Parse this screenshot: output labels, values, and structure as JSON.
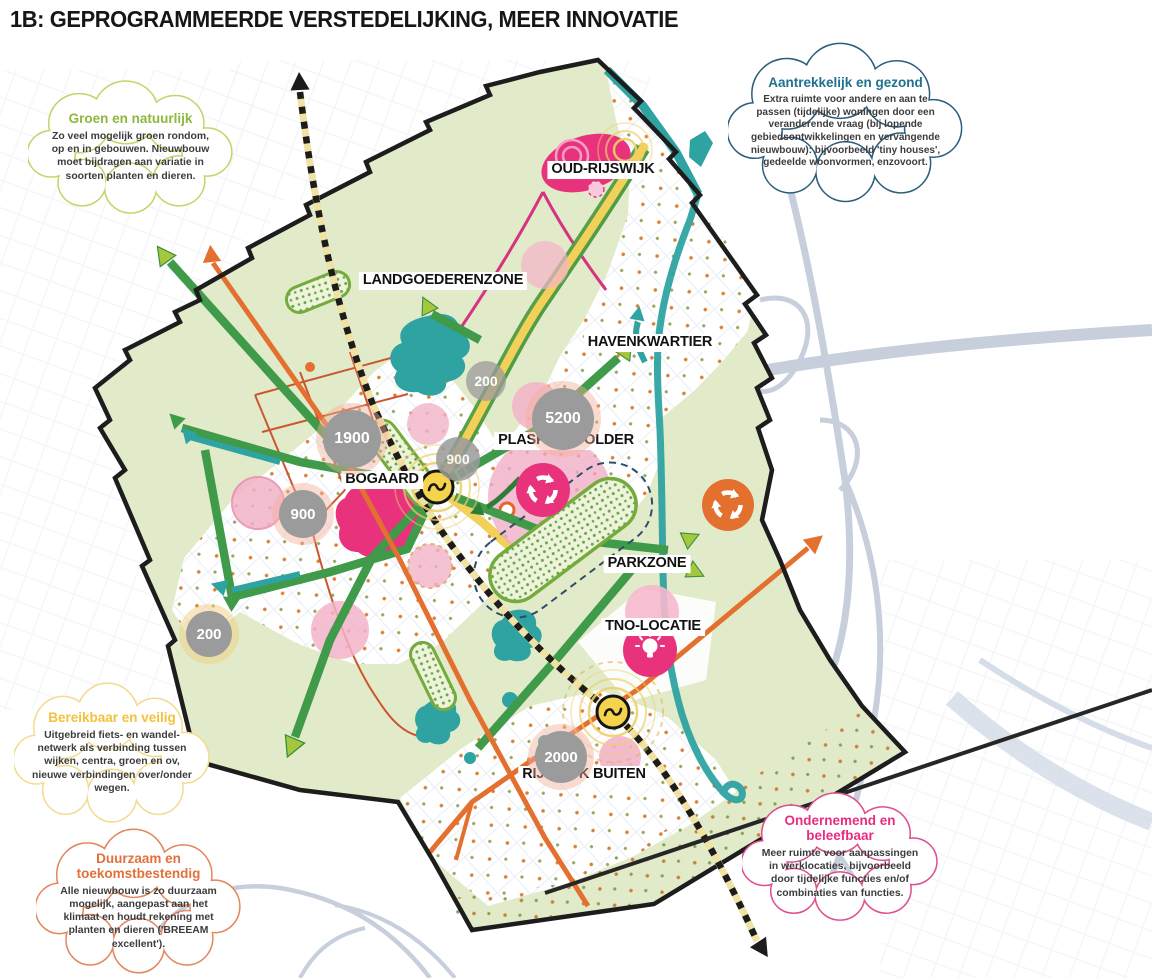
{
  "title": "1B: GEPROGRAMMEERDE VERSTEDELIJKING, MEER INNOVATIE",
  "clouds": {
    "groen": {
      "title": "Groen en natuurlijk",
      "body": "Zo veel mogelijk groen rondom, op en in gebouwen. Nieuwbouw moet bijdragen aan variatie in soorten planten en dieren.",
      "accent": "#8db83e"
    },
    "gezond": {
      "title": "Aantrekkelijk en gezond",
      "body": "Extra ruimte voor andere en aan te passen (tijdelijke) woningen door een veranderende vraag (bij lopende gebiedsontwikkelingen en vervangende nieuwbouw): bijvoorbeeld 'tiny houses', gedeelde woonvormen, enzovoort.",
      "accent": "#20718f"
    },
    "veilig": {
      "title": "Bereikbaar en veilig",
      "body": "Uitgebreid fiets- en wandel-netwerk als verbinding tussen wijken, centra, groen en ov, nieuwe verbindingen over/onder wegen.",
      "accent": "#f2c23a"
    },
    "duurzaam": {
      "title": "Duurzaam en toekomstbestendig",
      "body": "Alle nieuwbouw is zo duurzaam mogelijk, aangepast aan het klimaat en houdt rekening met planten en dieren ('BREEAM excellent').",
      "accent": "#e2703a"
    },
    "beleefbaar": {
      "title": "Ondernemend en beleefbaar",
      "body": "Meer ruimte voor aanpassingen in werklocaties, bijvoorbeeld door tijdelijke functies en/of combinaties van functies.",
      "accent": "#e82c80"
    }
  },
  "map": {
    "labels": {
      "oud_rijswijk": "OUD-RIJSWIJK",
      "landgoederenzone": "LANDGOEDERENZONE",
      "havenkwartier": "HAVENKWARTIER",
      "plaspoelpolder": "PLASPOELPOLDER",
      "bogaard": "BOGAARD",
      "parkzone": "PARKZONE",
      "tno": "TNO-LOCATIE",
      "rijswijk_buiten": "RIJSWIJK BUITEN"
    },
    "counts": {
      "landgoederen": "200",
      "bogaard_noord": "1900",
      "west": "900",
      "centrum": "900",
      "plaspoelpolder": "5200",
      "zuidwest": "200",
      "rijswijk_buiten": "2000"
    },
    "icons": {
      "station": "train-station-icon",
      "recycle": "circular-economy-icon",
      "lightbulb": "innovation-icon",
      "railway_arrow": "railway-direction-arrow"
    },
    "colors": {
      "area_green": "#e2ebc9",
      "network_green": "#3f9b4a",
      "arrow_light_green": "#a4c83d",
      "teal": "#2ea3a1",
      "orange": "#e4702f",
      "yellow_road": "#f2d05a",
      "magenta": "#e8337c",
      "light_pink": "#f3b3c9",
      "count_gray": "#9b9b9b",
      "boundary_black": "#1d1d1d",
      "highway_gray": "#c6cfdb"
    }
  }
}
